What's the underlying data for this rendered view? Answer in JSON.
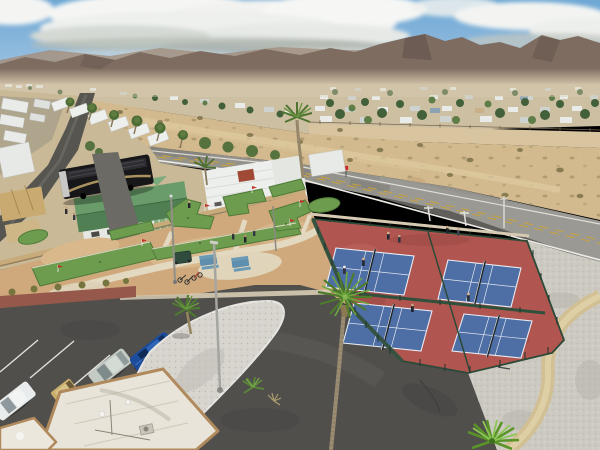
{
  "scene": {
    "type": "aerial-drone-photo",
    "description": "Aerial drone view of a desert RV resort recreation area: a mini golf course with artificial turf greens, four fenced pickleball courts in play, a curved driveway with a gravel island and palm trees, a small parking lot with cars, rows of RVs and mobile homes, an open sandy lot, a two-lane road, a mobile-home community, and mountains under a partly cloudy sky",
    "time_of_day": "daytime, partly cloudy"
  },
  "palette": {
    "sky_blue": "#6ea7d4",
    "cloud_white": "#f4f5f3",
    "mountain_brown": "#7e6c60",
    "desert_sand": "#d2b98e",
    "golf_ground_tan": "#cfa97c",
    "turf_green": "#6e9c4e",
    "court_red": "#b05550",
    "court_blue": "#4d6fa6",
    "fence_green": "#2c4a38",
    "road_gray": "#94928c",
    "driveway_asphalt": "#504f4c",
    "gravel_gray": "#ccc9c1",
    "wall_tan": "#c7ab7a",
    "house_roof_green": "#5f9260",
    "palm_green": "#6fa73e",
    "motorhome_black": "#17171a",
    "suv_blue": "#1c4c9c"
  },
  "objects": {
    "pickleball_courts": {
      "count": 4,
      "surface": "blue courts on red apron",
      "players": 8
    },
    "mini_golf_greens": {
      "count": 9,
      "surface": "artificial turf",
      "people": 6
    },
    "picnic_tables": {
      "count": 2,
      "color": "blue"
    },
    "cars_parked": {
      "count": 3
    },
    "golf_carts": {
      "count": 1
    },
    "palm_trees": {
      "count": 12
    },
    "black_motorhome": {
      "count": 1
    },
    "green_roof_house": {
      "count": 1
    },
    "seated_person": {
      "count": 1
    },
    "road_marking": "double yellow center line with white edge lines"
  }
}
